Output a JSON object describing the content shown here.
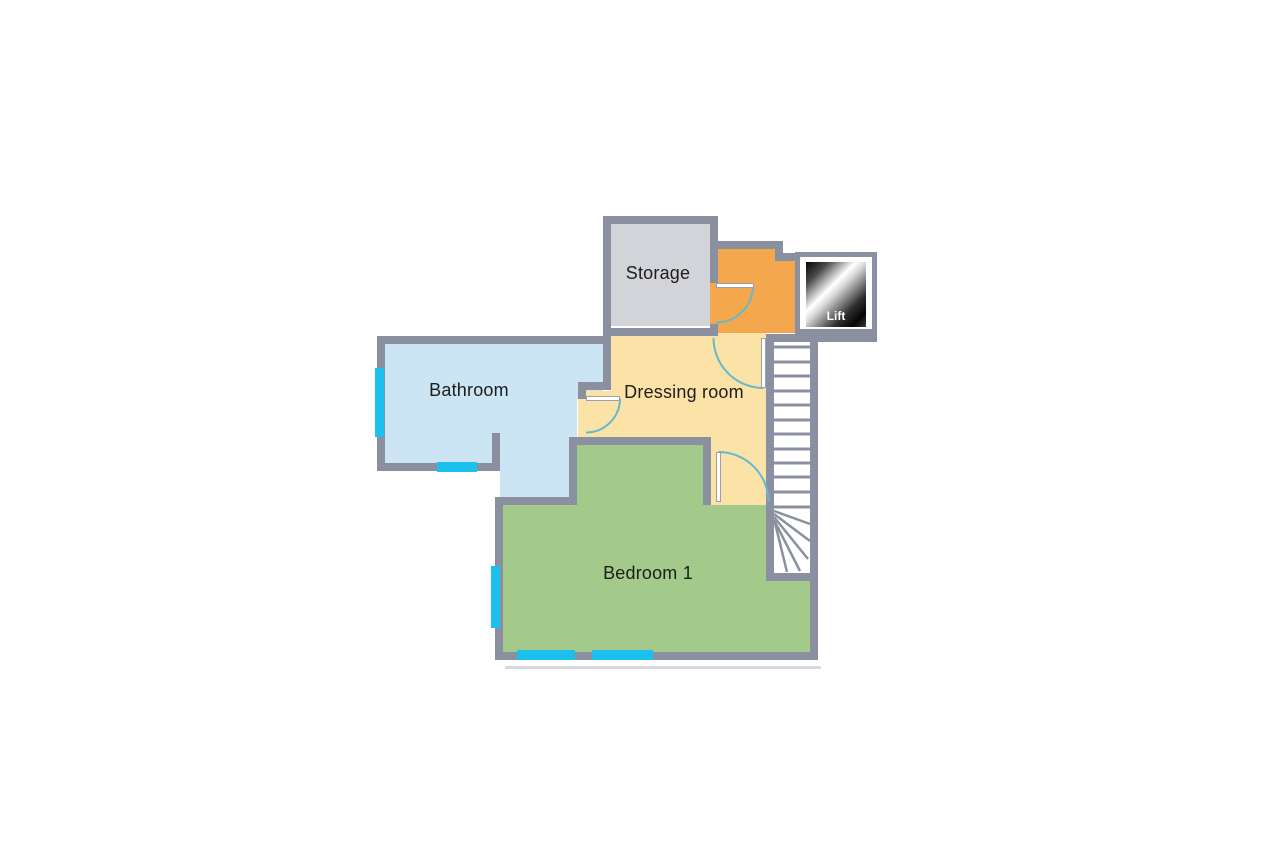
{
  "floorplan": {
    "background": "#ffffff",
    "wall_color": "#8b90a0",
    "window_color": "#1cc0ee",
    "door_arc_color": "#64b9cf",
    "label_color": "#1d1d1b",
    "rooms": {
      "storage": {
        "label": "Storage",
        "color": "#d3d4d9"
      },
      "bathroom": {
        "label": "Bathroom",
        "color": "#cbe5f4"
      },
      "dressing_room": {
        "label": "Dressing room",
        "color": "#fbe2a7"
      },
      "bedroom_1": {
        "label": "Bedroom 1",
        "color": "#a3ca8b"
      },
      "landing": {
        "color": "#f5a74e"
      },
      "lift": {
        "label": "Lift",
        "color_start": "#050505",
        "color_mid": "#ffffff"
      }
    },
    "stairs": {
      "tread_count": 12
    }
  }
}
